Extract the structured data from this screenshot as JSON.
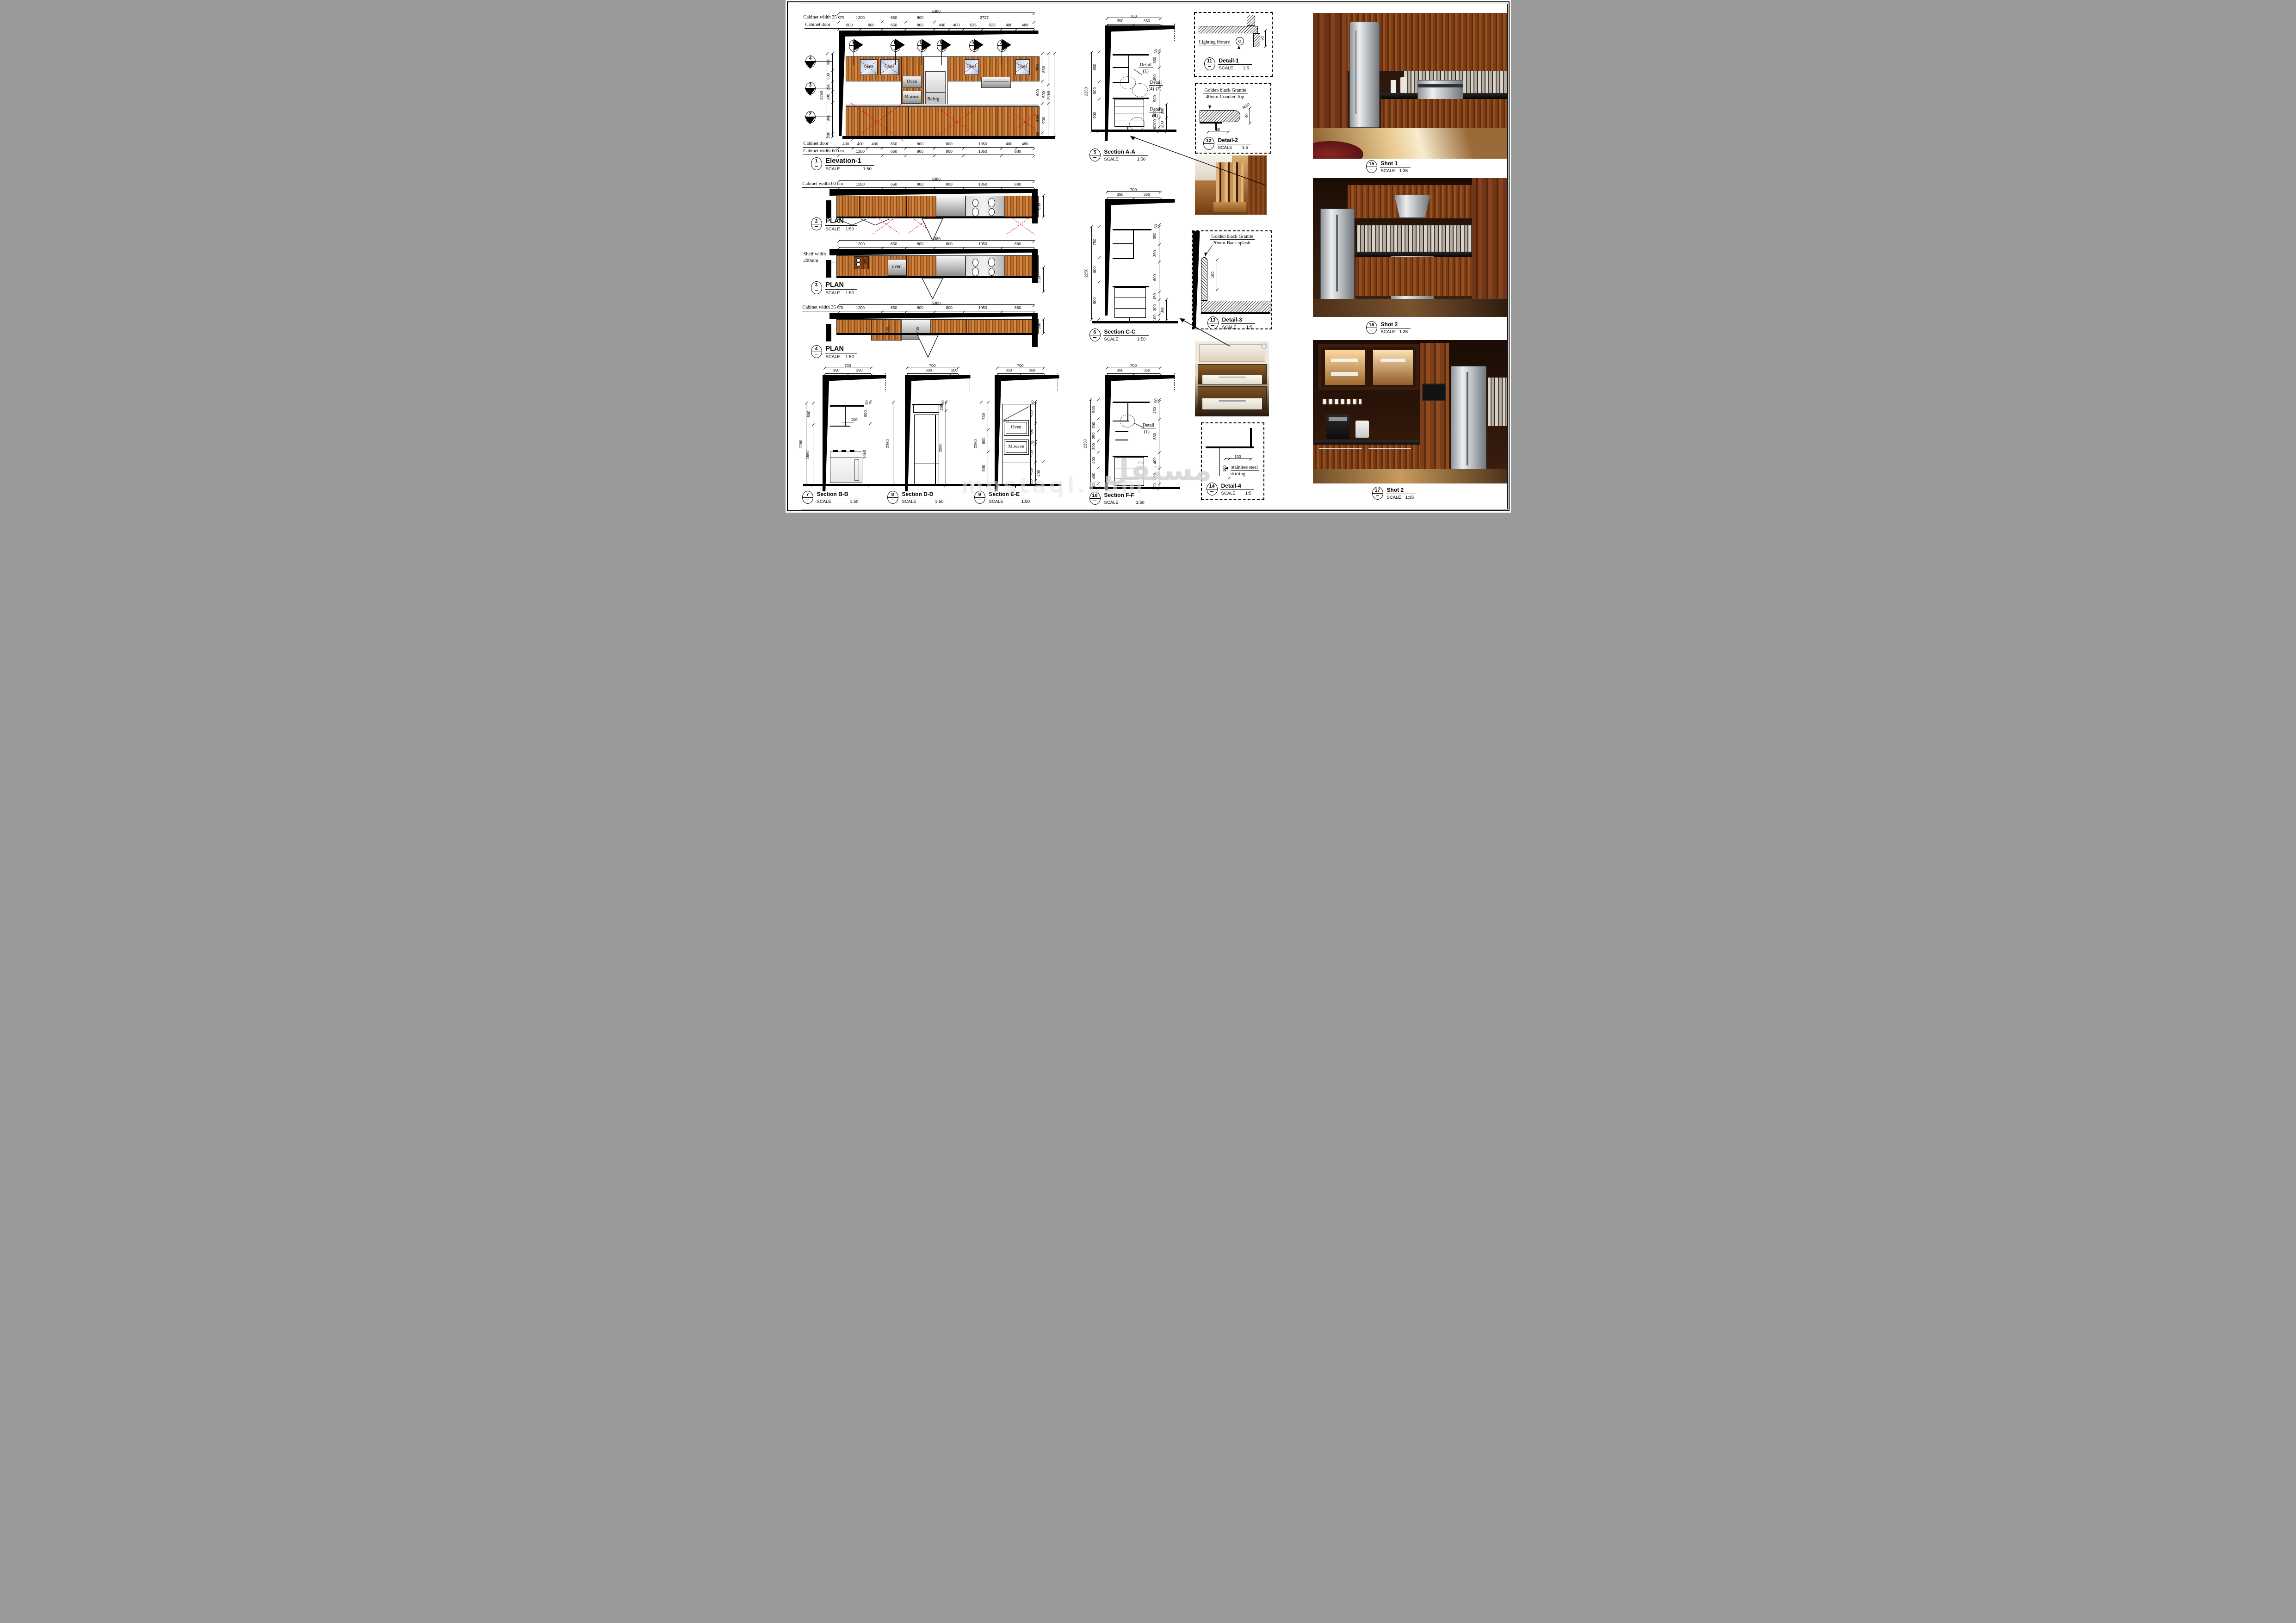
{
  "elevation1": {
    "overall_dim": "5380",
    "width_row_label": "Cabinet width 35 cm",
    "width_row_dims": [
      "1200",
      "650",
      "800",
      "2727"
    ],
    "door_row_label": "Cabinet door",
    "door_row_dims": [
      "600",
      "600",
      "650",
      "800",
      "400",
      "400",
      "525",
      "525",
      "400",
      "480"
    ],
    "section_markers": [
      "F",
      "E",
      "D",
      "C",
      "B",
      "A"
    ],
    "level_markers": [
      "4",
      "3",
      "2"
    ],
    "left_total_dim": "2250",
    "left_dims": [
      "450",
      "300",
      "250",
      "300",
      "800",
      "100"
    ],
    "right_dims_inner": [
      "750",
      "600",
      "800",
      "100"
    ],
    "right_dims_mid": [
      "850",
      "500",
      "900"
    ],
    "right_total_dim": "2250",
    "glass_labels": [
      "Glass",
      "Glass",
      "Glass",
      "Glass"
    ],
    "oven_label": "Oven",
    "mwave_label": "M.wave",
    "refrig_label": "Refrig.",
    "bottom_door_label": "Cabinet door",
    "bottom_door_dims": [
      "400",
      "400",
      "400",
      "650",
      "800",
      "800",
      "1050",
      "400",
      "480"
    ],
    "bottom_width_label": "Cabinet width  60 cm",
    "bottom_width_dims": [
      "1200",
      "650",
      "800",
      "800",
      "1050",
      "880"
    ],
    "title": {
      "num": "1",
      "name": "Elevation-1",
      "scale_label": "SCALE",
      "scale": "1:50"
    }
  },
  "plan2": {
    "overall_dim": "5380",
    "width_row_label": "Cabinet width 60 cm",
    "width_row_dims": [
      "1200",
      "650",
      "800",
      "800",
      "1050",
      "880"
    ],
    "depth_dim": "600",
    "title": {
      "num": "2",
      "name": "PLAN",
      "scale_label": "SCALE",
      "scale": "1:50"
    }
  },
  "plan3": {
    "overall_dim": "5380",
    "width_row_dims": [
      "1200",
      "650",
      "800",
      "800",
      "1050",
      "880"
    ],
    "shelf_note_line1": "Shelf width",
    "shelf_note_line2": "200mm",
    "shelf_dim": "200",
    "oven_label": "oven",
    "right_dim": "338",
    "title": {
      "num": "3",
      "name": "PLAN",
      "scale_label": "SCALE",
      "scale": "1:50"
    }
  },
  "plan4": {
    "overall_dim": "5380",
    "width_row_label": "Cabinet width  35 cm",
    "width_row_dims": [
      "1200",
      "650",
      "800",
      "800",
      "1050",
      "880"
    ],
    "inner_dims": [
      "600",
      "600"
    ],
    "depth_dim": "350",
    "title": {
      "num": "4",
      "name": "PLAN",
      "scale_label": "SCALE",
      "scale": "1:50"
    }
  },
  "sectionAA": {
    "top_total_dim": "700",
    "top_dims": [
      "350",
      "350"
    ],
    "left_total_dim": "2250",
    "left_dims": [
      "850",
      "500",
      "900"
    ],
    "right_dims": [
      "50",
      "350",
      "450",
      "500",
      "200",
      "200",
      "100"
    ],
    "right_outer_dims": [
      "200",
      "200"
    ],
    "callout1_line1": "Detail",
    "callout1_line2": "(1)",
    "callout2_line1": "Detail",
    "callout2_line2": "(4)-(2)",
    "callout3_line1": "Detail",
    "callout3_line2": "(4)",
    "title": {
      "num": "5",
      "name": "Section A-A",
      "scale_label": "SCALE",
      "scale": "1:50"
    }
  },
  "sectionCC": {
    "top_total_dim": "700",
    "top_dims": [
      "350",
      "350"
    ],
    "left_total_dim": "2250",
    "left_dims": [
      "750",
      "600",
      "900"
    ],
    "right_dims": [
      "50",
      "350",
      "350",
      "600",
      "150",
      "300",
      "100"
    ],
    "right_outer_dims": [
      "350"
    ],
    "title": {
      "num": "6",
      "name": "Section C-C",
      "scale_label": "SCALE",
      "scale": "1:50"
    }
  },
  "sectionBB": {
    "top_total_dim": "700",
    "top_dims": [
      "350",
      "350"
    ],
    "left_total_dim": "2250",
    "left_dims": [
      "600",
      "1650"
    ],
    "note_dim": "100",
    "right_dims": [
      "50",
      "550",
      "1650"
    ],
    "title": {
      "num": "7",
      "name": "Section B-B",
      "scale_label": "SCALE",
      "scale": "1:50"
    }
  },
  "sectionDD": {
    "top_total_dim": "700",
    "top_dims": [
      "600",
      "100"
    ],
    "left_total_dim": "2250",
    "right_dims": [
      "50",
      "200",
      "2000"
    ],
    "title": {
      "num": "8",
      "name": "Section D-D",
      "scale_label": "SCALE",
      "scale": "1:50"
    }
  },
  "sectionEE": {
    "top_total_dim": "700",
    "top_dims": [
      "350",
      "350"
    ],
    "left_total_dim": "2250",
    "left_dims": [
      "750",
      "600",
      "900"
    ],
    "right_dims": [
      "50",
      "430",
      "400",
      "70",
      "400",
      "400",
      "100"
    ],
    "right_outer_dims": [
      "400"
    ],
    "oven_label": "Oven",
    "mwave_label": "M.wave",
    "title": {
      "num": "9",
      "name": "Section E-E",
      "scale_label": "SCALE",
      "scale": "1:50"
    }
  },
  "sectionFF": {
    "top_total_dim": "700",
    "top_dims": [
      "350",
      "350"
    ],
    "left_total_dim": "2250",
    "left_dims": [
      "500",
      "300",
      "250",
      "300",
      "400",
      "400",
      "100"
    ],
    "right_dims": [
      "50",
      "450",
      "850",
      "400",
      "400",
      "100"
    ],
    "callout1_line1": "Detail",
    "callout1_line2": "(1)",
    "title": {
      "num": "10",
      "name": "Section F-F",
      "scale_label": "SCALE",
      "scale": "1:50"
    }
  },
  "detail1": {
    "annotation": "Lighting fixture",
    "dim": "50",
    "title": {
      "num": "11",
      "name": "Detail-1",
      "scale_label": "SCALE",
      "scale": "1:5"
    }
  },
  "detail2": {
    "annotation_line1": "Golden black Granite",
    "annotation_line2": "40mm-Counter Top",
    "radius_label": "R10",
    "thickness_dim": "40",
    "overhang_dim": "50",
    "title": {
      "num": "12",
      "name": "Detail-2",
      "scale_label": "SCALE",
      "scale": "1:5"
    }
  },
  "detail3": {
    "annotation_line1": "Golden black Granite",
    "annotation_line2": "20mm-Back splash",
    "height_dim": "100",
    "title": {
      "num": "13",
      "name": "Detail-3",
      "scale_label": "SCALE",
      "scale": "1:5"
    }
  },
  "detail4": {
    "annotation_line1": "stainless steel",
    "annotation_line2": "skirting",
    "width_dim": "100",
    "height_dim": "100",
    "title": {
      "num": "14",
      "name": "Detail-4",
      "scale_label": "SCALE",
      "scale": "1:5"
    }
  },
  "shots": [
    {
      "title": {
        "num": "15",
        "name": "Shot 1",
        "scale_label": "SCALE",
        "scale": "1:35"
      }
    },
    {
      "title": {
        "num": "16",
        "name": "Shot 2",
        "scale_label": "SCALE",
        "scale": "1:35"
      }
    },
    {
      "title": {
        "num": "17",
        "name": "Shot 2",
        "scale_label": "SCALE",
        "scale": "1:35"
      }
    }
  ],
  "watermark": {
    "arabic": "مستقل",
    "latin": "mostaql.com"
  }
}
